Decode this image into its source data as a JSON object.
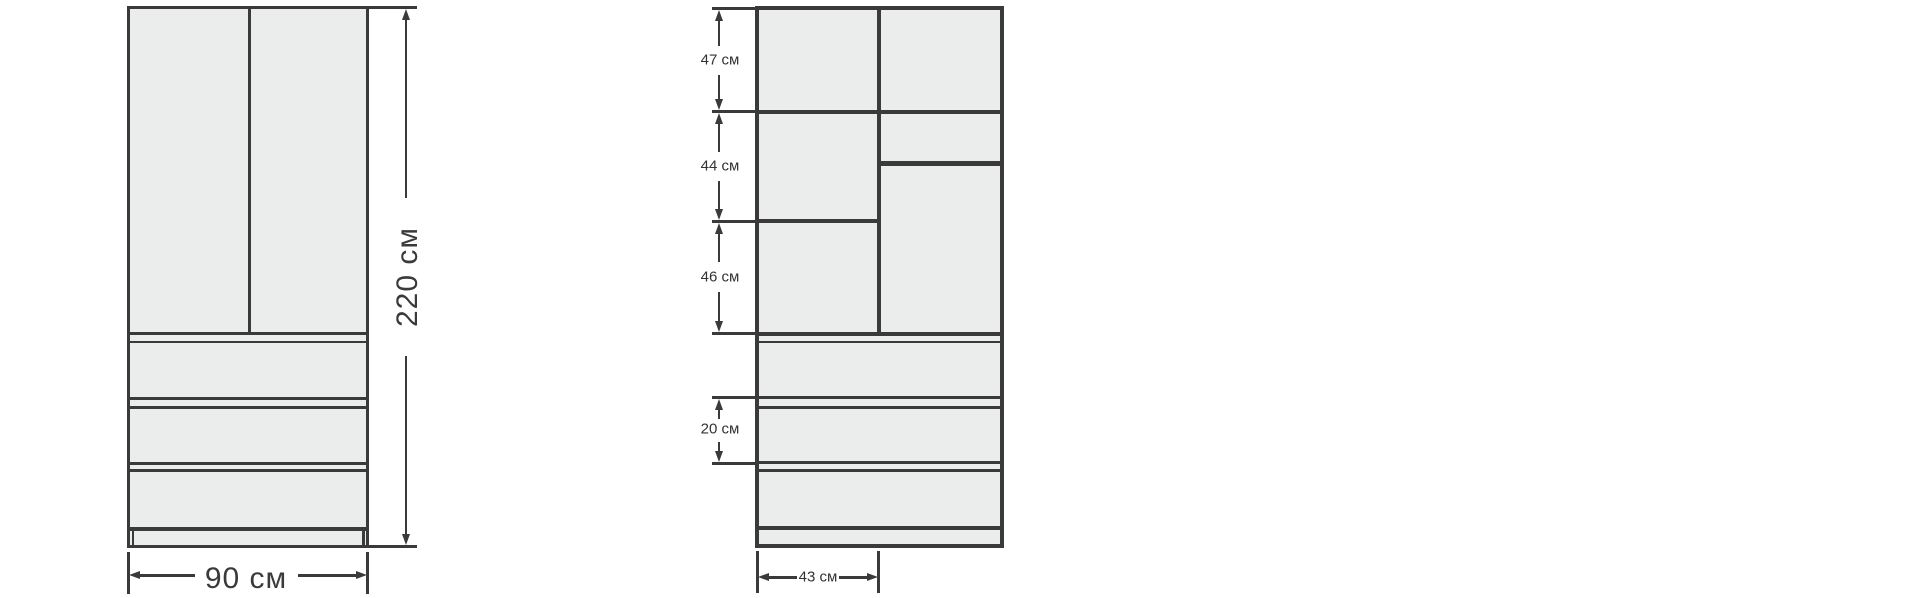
{
  "diagram": {
    "front_view": {
      "height_label": "220 см",
      "width_label": "90 см",
      "doors_count": 2,
      "drawers_count": 3
    },
    "internal_view": {
      "section_labels": [
        "47 см",
        "44 см",
        "46 см"
      ],
      "drawer_height_label": "20 см",
      "column_width_label": "43 см"
    },
    "measurements_cm": {
      "total_height": 220,
      "total_width": 90,
      "top_section_height": 47,
      "middle_section_height": 44,
      "lower_section_height": 46,
      "drawer_height": 20,
      "left_column_width": 43
    },
    "colors": {
      "line": "#3a3a3a",
      "panel_fill": "#ebecec",
      "background": "#ffffff",
      "label_text": "#333333"
    }
  }
}
